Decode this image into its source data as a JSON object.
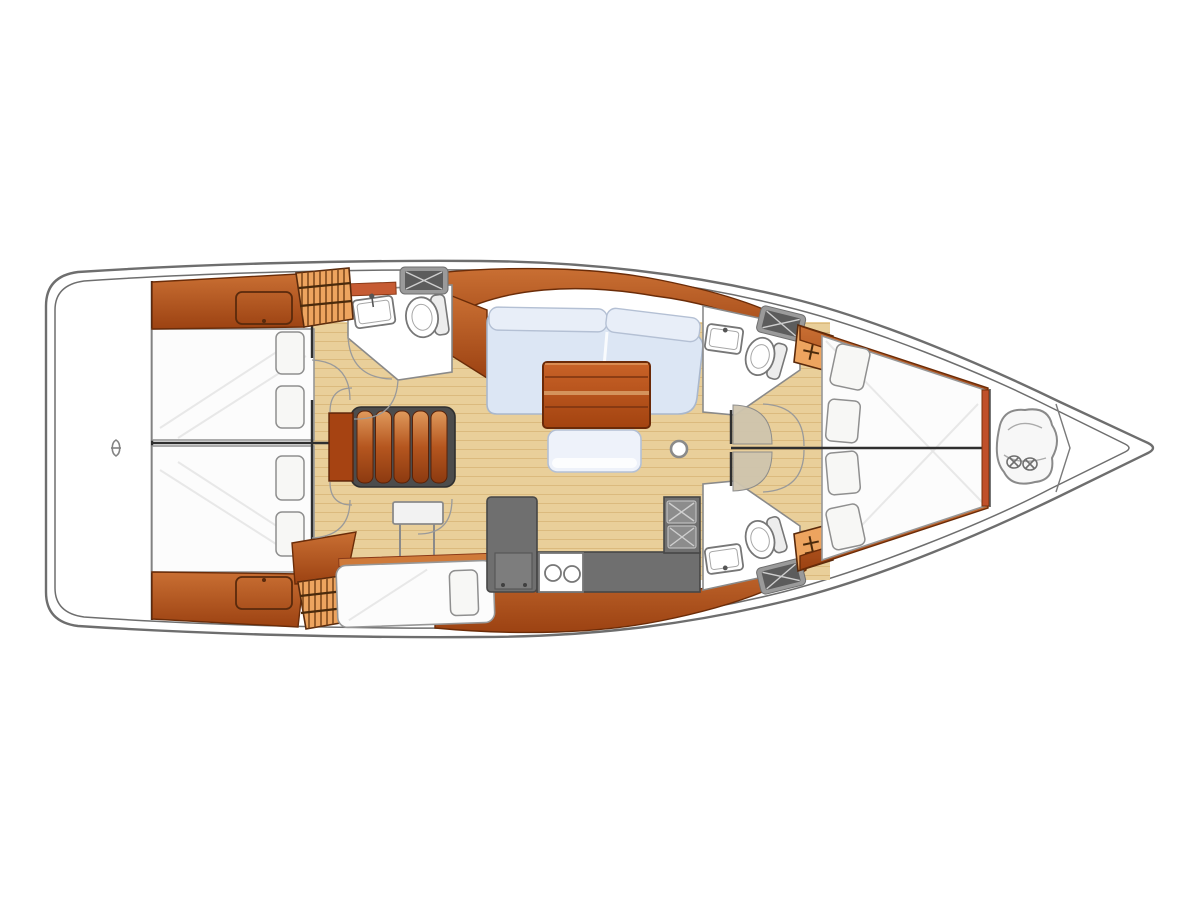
{
  "image": {
    "kind": "sailboat-interior-floor-plan",
    "width": 1200,
    "height": 900,
    "orientation": "bow-right-stern-left",
    "background": "#ffffff"
  },
  "colors": {
    "hull_line": "#6e6e6e",
    "bulkhead": "#2f2f2f",
    "floor": "#e9cf9a",
    "floor_line": "#cfa968",
    "wood_hi": "#cf7a3a",
    "wood": "#b05523",
    "wood_dark": "#6b2c08",
    "locker": "#eda45f",
    "locker_stripe": "#7a4418",
    "counter": "#6f6f6f",
    "counter_dark": "#474747",
    "settee": "#dce6f4",
    "settee_border": "#a9b7cc",
    "mattress": "#fcfcfc",
    "mattress_border": "#979797",
    "fixture_line": "#777777",
    "sheen": "#e6e6e6"
  },
  "features": [
    {
      "name": "hull-outline"
    },
    {
      "name": "swim-platform"
    },
    {
      "name": "transom-glyph"
    },
    {
      "name": "aft-cabin-port-berth"
    },
    {
      "name": "aft-cabin-starboard-berth"
    },
    {
      "name": "companionway-steps"
    },
    {
      "name": "aft-head-toilet"
    },
    {
      "name": "aft-head-washbasin"
    },
    {
      "name": "saloon-settee"
    },
    {
      "name": "saloon-table"
    },
    {
      "name": "saloon-bench"
    },
    {
      "name": "chaise-berth"
    },
    {
      "name": "chart-table"
    },
    {
      "name": "galley-counter"
    },
    {
      "name": "galley-twin-sinks"
    },
    {
      "name": "galley-stove"
    },
    {
      "name": "forward-head-port"
    },
    {
      "name": "forward-head-starboard"
    },
    {
      "name": "v-berth"
    },
    {
      "name": "anchor-locker-bag"
    },
    {
      "name": "mast-post"
    },
    {
      "name": "hanging-lockers"
    },
    {
      "name": "deck-hatches"
    }
  ],
  "counts": {
    "aft_cabins": 2,
    "toilets": 3,
    "washbasins": 3,
    "galley_sink_bowls": 2,
    "stove_burners": 2,
    "stair_treads": 5,
    "hanging_lockers": 4,
    "deck_hatches": 3,
    "pillows_aft_port": 2,
    "pillows_aft_starboard": 2,
    "pillows_v_berth": 4,
    "pillows_chaise": 1,
    "masts": 1
  }
}
